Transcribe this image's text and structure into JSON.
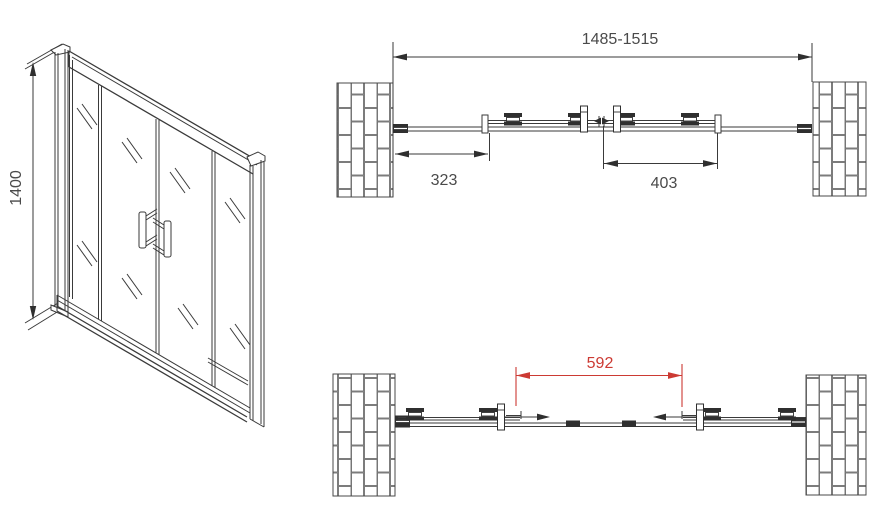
{
  "front_view": {
    "height_label": "1400"
  },
  "plan_closed_view": {
    "total_width_label": "1485-1515",
    "left_section_label": "323",
    "door_panel_label": "403"
  },
  "plan_open_view": {
    "opening_width_label": "592"
  },
  "colors": {
    "line": "#3a3a3a",
    "text": "#4a4a4a",
    "accent_red": "#cc3a33",
    "background": "#ffffff"
  }
}
